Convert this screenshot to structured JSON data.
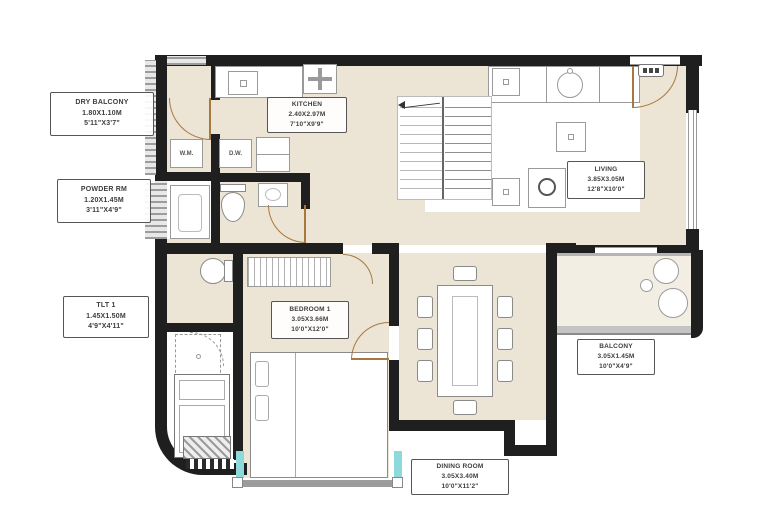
{
  "plan": {
    "title": "apartment-floor-plan",
    "colors": {
      "floor": "#ece5d6",
      "wall": "#1f1f1f",
      "glass": "#8ed9d9",
      "door": "#a8793f",
      "railing": "#c4c4c4"
    },
    "rooms": {
      "dry_balcony": {
        "name": "DRY BALCONY",
        "meters": "1.80X1.10M",
        "feet": "5'11\"X3'7\""
      },
      "powder": {
        "name": "POWDER RM",
        "meters": "1.20X1.45M",
        "feet": "3'11\"X4'9\""
      },
      "tlt1": {
        "name": "TLT 1",
        "meters": "1.45X1.50M",
        "feet": "4'9\"X4'11\""
      },
      "kitchen": {
        "name": "KITCHEN",
        "meters": "2.40X2.97M",
        "feet": "7'10\"X9'9\""
      },
      "living": {
        "name": "LIVING",
        "meters": "3.85X3.05M",
        "feet": "12'8\"X10'0\""
      },
      "bedroom": {
        "name": "BEDROOM 1",
        "meters": "3.05X3.66M",
        "feet": "10'0\"X12'0\""
      },
      "dining": {
        "name": "DINING ROOM",
        "meters": "3.05X3.40M",
        "feet": "10'0\"X11'2\""
      },
      "balcony": {
        "name": "BALCONY",
        "meters": "3.05X1.45M",
        "feet": "10'0\"X4'9\""
      }
    },
    "appliances": {
      "wm": "W.M.",
      "dw": "D.W."
    }
  }
}
